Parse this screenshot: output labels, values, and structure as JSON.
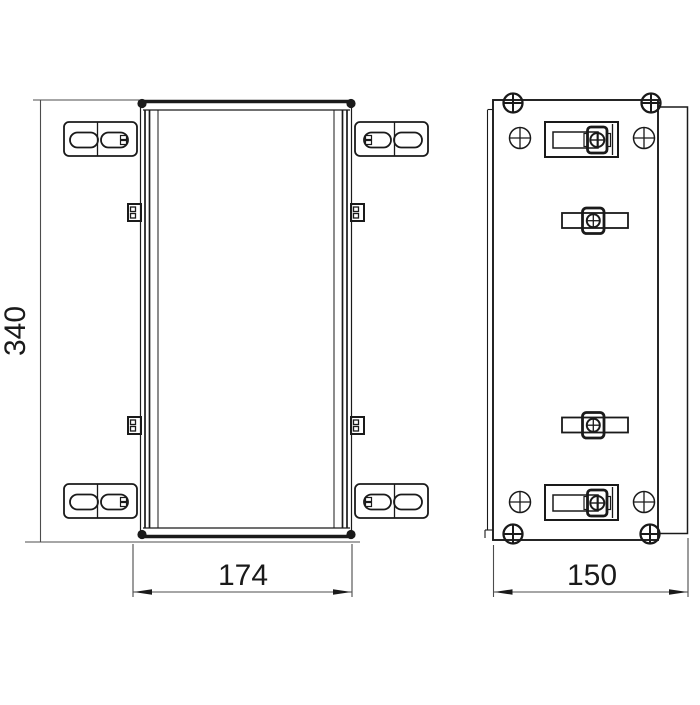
{
  "drawing": {
    "dim_height": "340",
    "dim_width": "174",
    "dim_depth": "150",
    "colors": {
      "line": "#1a1a1a",
      "dimension": "#4c4c4c",
      "background": "#ffffff"
    }
  }
}
